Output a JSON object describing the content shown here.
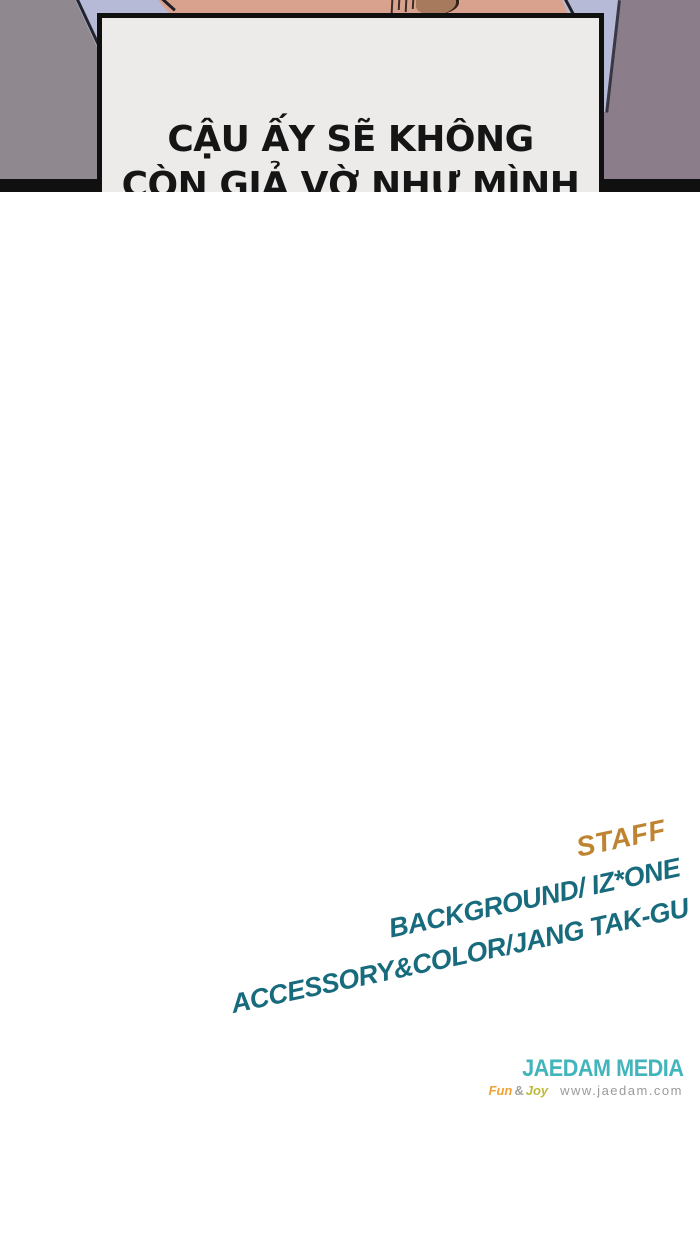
{
  "dialogue": {
    "text": "CẬU ẤY SẼ KHÔNG\nCÒN GIẢ VỜ NHƯ MÌNH\nKHÔNG THẤY GÌ NỮA."
  },
  "credits": {
    "staff_label": "STAFF",
    "lines": [
      {
        "label": "BACKGROUND/ IZ*ONE"
      },
      {
        "label": "ACCESSORY&COLOR/JANG TAK-GU"
      }
    ]
  },
  "publisher": {
    "name": "JAEDAM MEDIA",
    "tagline": {
      "fun": "Fun",
      "amp": "&",
      "joy": "Joy"
    },
    "website": "www.jaedam.com"
  },
  "colors": {
    "wall_left": "#8f888e",
    "wall_right": "#8b7d8a",
    "shirt": "#b6bad7",
    "skin": "#d9a28e",
    "hair": "#a87a5d",
    "ink": "#101010",
    "box_fill": "#ecebe9",
    "staff_orange": "#bf8431",
    "credit_teal": "#186b7d",
    "logo_teal": "#41b4bc",
    "fun_orange": "#f0a232",
    "joy_green": "#bfba3a",
    "muted_gray": "#9b9b9b"
  }
}
